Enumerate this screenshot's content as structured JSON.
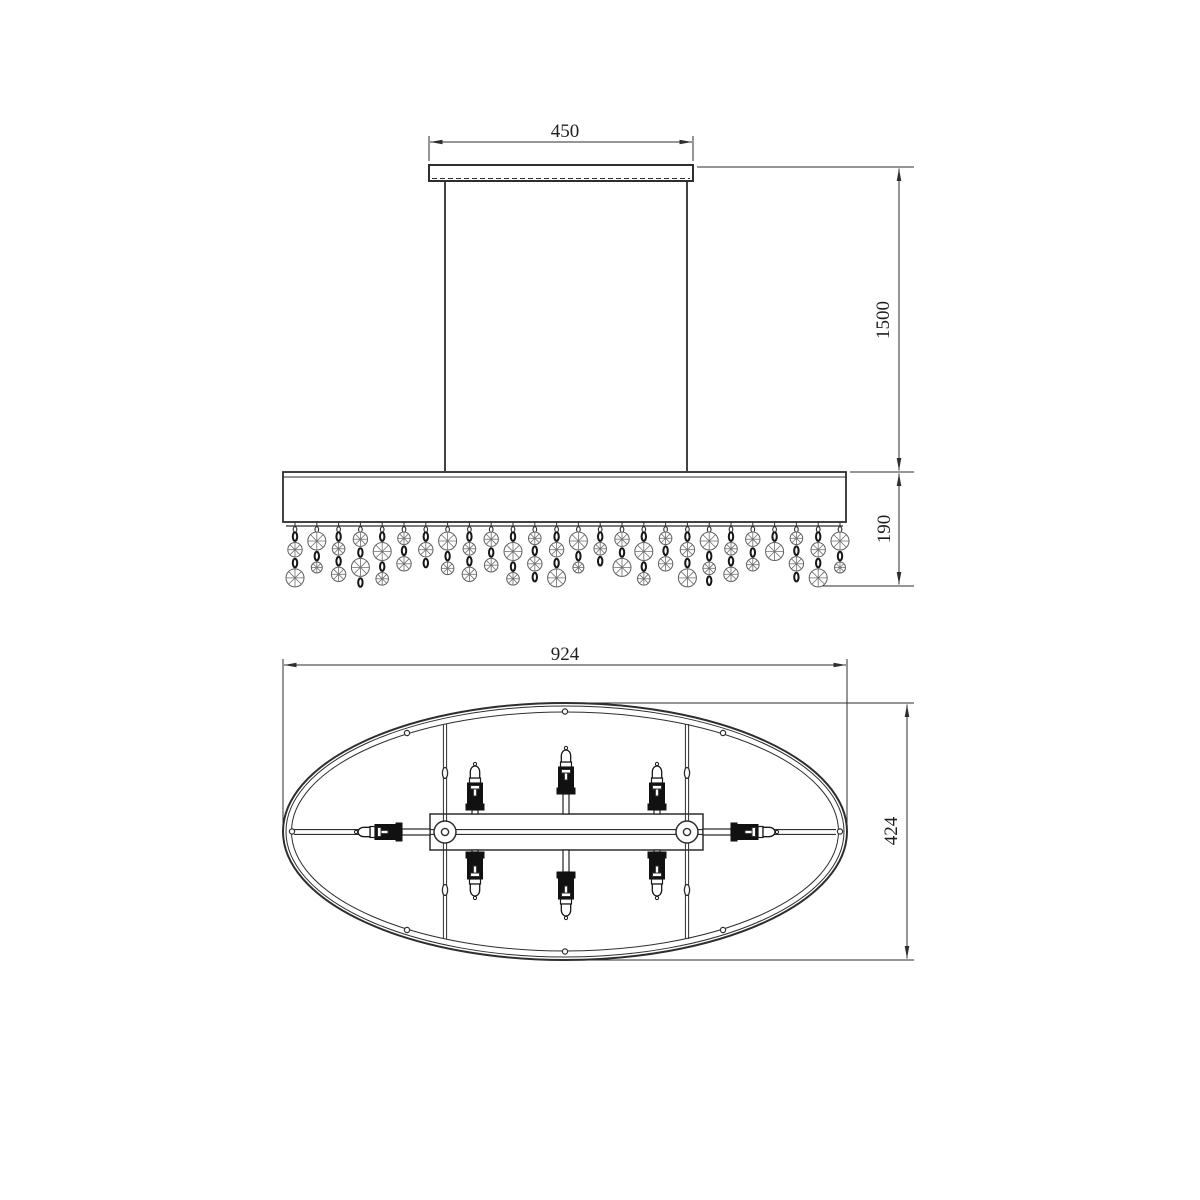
{
  "colors": {
    "background": "#ffffff",
    "line": "#2e2e2e",
    "dark_fill": "#111111",
    "crystal": "#6f6f6f"
  },
  "dimensions": {
    "canopy_width": "450",
    "drop_height": "1500",
    "shade_height": "190",
    "fixture_length": "924",
    "fixture_width": "424"
  },
  "structure": {
    "crystal_strand_count": 26,
    "bulb_count": 8,
    "rim_hole_count": 8,
    "suspension_rod_count": 2
  }
}
